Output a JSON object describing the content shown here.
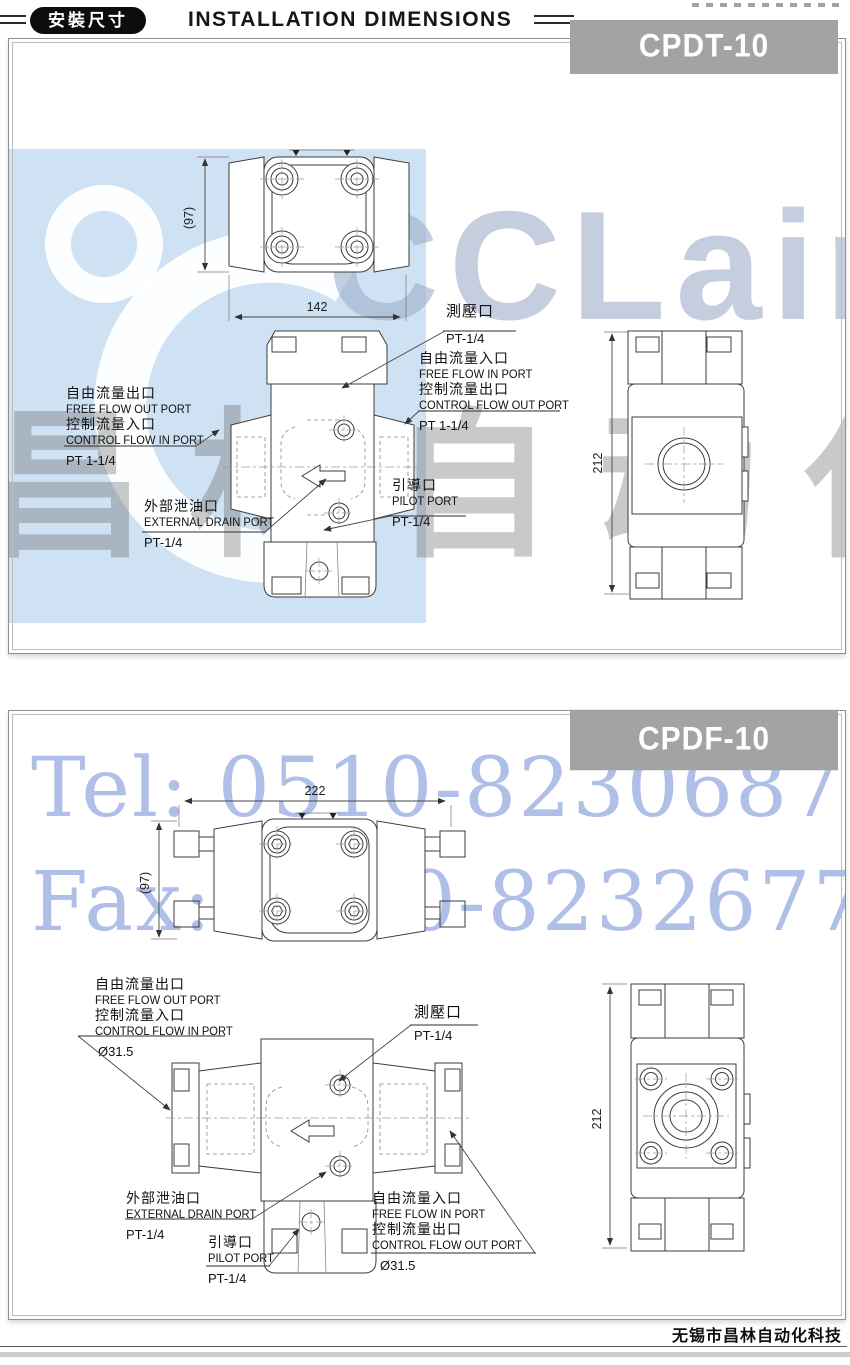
{
  "header": {
    "badge": "安裝尺寸",
    "title": "INSTALLATION DIMENSIONS"
  },
  "watermarks": {
    "logo_text": "CCLair",
    "cn_text": "昌林自动化",
    "tel": "Tel: 0510-82306871",
    "fax": "Fax: 0510-82326771",
    "accent_blue": "#cfe2f4",
    "text_blue": "#8ea5dd"
  },
  "panel1": {
    "model": "CPDT-10",
    "dims": {
      "top_width": "142",
      "top_height": "(97)",
      "side_height": "212"
    },
    "labels": {
      "test": [
        "測壓口",
        "PT-1/4"
      ],
      "free_in": [
        "自由流量入口",
        "FREE FLOW IN PORT",
        "控制流量出口",
        "CONTROL FLOW OUT PORT",
        "PT 1-1/4"
      ],
      "free_out": [
        "自由流量出口",
        "FREE FLOW OUT PORT",
        "控制流量入口",
        "CONTROL FLOW IN PORT",
        "PT 1-1/4"
      ],
      "drain": [
        "外部泄油口",
        "EXTERNAL DRAIN PORT",
        "PT-1/4"
      ],
      "pilot": [
        "引導口",
        "PILOT PORT",
        "PT-1/4"
      ]
    }
  },
  "panel2": {
    "model": "CPDF-10",
    "dims": {
      "top_width": "222",
      "top_height": "(97)",
      "side_height": "212"
    },
    "labels": {
      "free_out": [
        "自由流量出口",
        "FREE FLOW OUT PORT",
        "控制流量入口",
        "CONTROL FLOW IN PORT",
        "Ø31.5"
      ],
      "test": [
        "測壓口",
        "PT-1/4"
      ],
      "drain": [
        "外部泄油口",
        "EXTERNAL DRAIN PORT",
        "PT-1/4"
      ],
      "pilot": [
        "引導口",
        "PILOT PORT",
        "PT-1/4"
      ],
      "free_in": [
        "自由流量入口",
        "FREE FLOW IN PORT",
        "控制流量出口",
        "CONTROL FLOW OUT PORT",
        "Ø31.5"
      ]
    }
  },
  "footer": {
    "company": "无锡市昌林自动化科技"
  }
}
